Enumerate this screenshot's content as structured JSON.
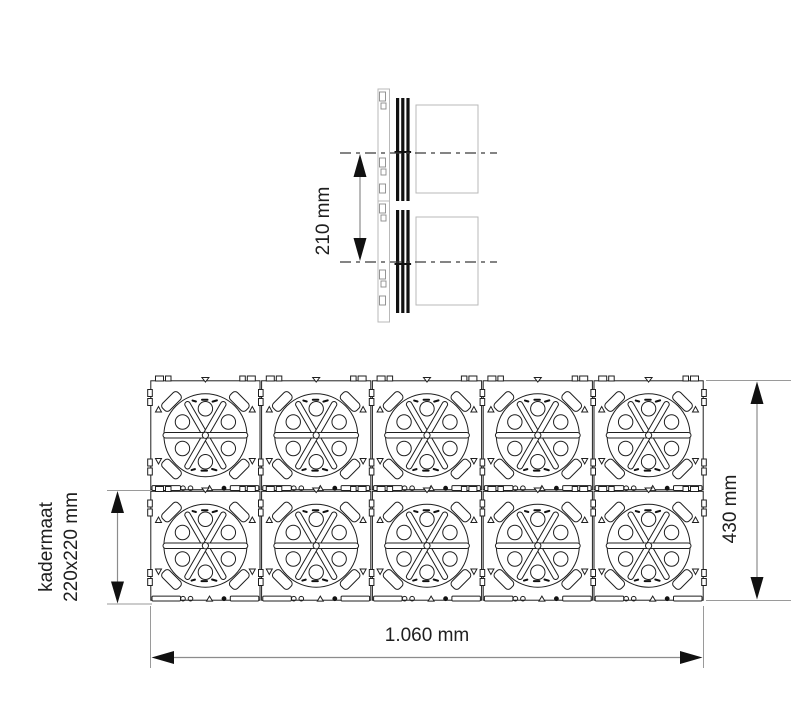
{
  "title": "Flush-mount frame technical drawing",
  "labels": {
    "spacing": "210 mm",
    "frame_name": "kadermaat",
    "frame_size": "220x220 mm",
    "height": "430 mm",
    "width": "1.060 mm"
  },
  "grid": {
    "cols": 5,
    "rows": 2,
    "modules": 10
  },
  "side_view": {
    "units": 2
  },
  "colors": {
    "line": "#1f1f1f",
    "light_line": "#b9b9b9",
    "dim_line": "#8c8c8c",
    "arrow": "#111111",
    "background": "#ffffff"
  }
}
